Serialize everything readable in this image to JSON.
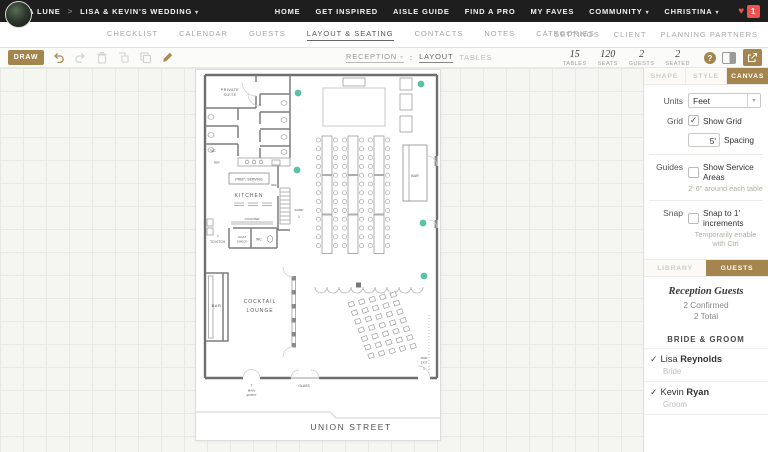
{
  "colors": {
    "accent_gold": "#a5854e",
    "seat_marker_teal": "#58c1a6",
    "notification_red": "#ef5350",
    "wall_gray": "#6e6e6e"
  },
  "top_bar": {
    "brand": "TO LA LUNE",
    "breadcrumb_sep": ">",
    "project": "LISA & KEVIN'S WEDDING",
    "nav": [
      "HOME",
      "GET INSPIRED",
      "AISLE GUIDE",
      "FIND A PRO",
      "MY FAVES",
      "COMMUNITY",
      "CHRISTINA"
    ],
    "notification_count": "1"
  },
  "project_nav": {
    "items": [
      "CHECKLIST",
      "CALENDAR",
      "GUESTS",
      "LAYOUT & SEATING",
      "CONTACTS",
      "NOTES",
      "CATEGORIES"
    ],
    "active_item": "LAYOUT & SEATING",
    "right_items": [
      "SETTINGS",
      "CLIENT",
      "PLANNING PARTNERS"
    ]
  },
  "toolbar": {
    "draw_label": "DRAW",
    "layout_select": "RECEPTION",
    "view_colon": ":",
    "view_tabs": [
      "LAYOUT",
      "TABLES"
    ],
    "stats": [
      {
        "value": "15",
        "label": "TABLES"
      },
      {
        "value": "120",
        "label": "SEATS"
      },
      {
        "value": "2",
        "label": "GUESTS"
      },
      {
        "value": "2",
        "label": "SEATED"
      }
    ],
    "help_label": "?"
  },
  "panel": {
    "tabs": [
      "SHAPE",
      "STYLE",
      "CANVAS"
    ],
    "active_tab": "CANVAS",
    "units": {
      "label": "Units",
      "value": "Feet"
    },
    "grid": {
      "label": "Grid",
      "check": "✓",
      "checkbox_label": "Show Grid",
      "spacing_value": "5'",
      "spacing_label": "Spacing"
    },
    "guides": {
      "label": "Guides",
      "checkbox_label": "Show Service Areas",
      "subtext": "2' 6\" around each table"
    },
    "snap": {
      "label": "Snap",
      "checkbox_label": "Snap to 1' increments",
      "subtext": "Temporarily enable with Ctrl"
    },
    "lower_tabs": [
      "LIBRARY",
      "GUESTS"
    ],
    "active_lower_tab": "GUESTS",
    "guests": {
      "title": "Reception Guests",
      "confirmed": "2 Confirmed",
      "total": "2 Total",
      "group": "BRIDE & GROOM",
      "check": "✓",
      "list": [
        {
          "first": "Lisa",
          "last": "Reynolds",
          "role": "Bride"
        },
        {
          "first": "Kevin",
          "last": "Ryan",
          "role": "Groom"
        }
      ]
    }
  },
  "floor_plan": {
    "labels": {
      "private_suite_l1": "PRIVATE",
      "private_suite_l2": "SUITE",
      "wc_a": "WC",
      "ref_a": "REF",
      "ref_b": "REF",
      "prep_serving": "PREP / SERVING",
      "kitchen": "KITCHEN",
      "counter": "COUNTER",
      "ramp": "RAMP",
      "to_kitch": "TO KITCH.",
      "coat_l1": "COAT",
      "coat_l2": "CHECK",
      "wc_b": "WC",
      "bar_left": "BAR",
      "bar_right": "BAR",
      "cocktail_l1": "COCKTAIL",
      "cocktail_l2": "LOUNGE",
      "glass": "GLASS",
      "main_entry_l1": "MAIN",
      "main_entry_l2": "ENTRY",
      "fire_exit_l1": "FIRE",
      "fire_exit_l2": "EXIT",
      "arrow_up": "⇧",
      "arrow_down": "⇩",
      "union_street": "UNION STREET"
    }
  }
}
